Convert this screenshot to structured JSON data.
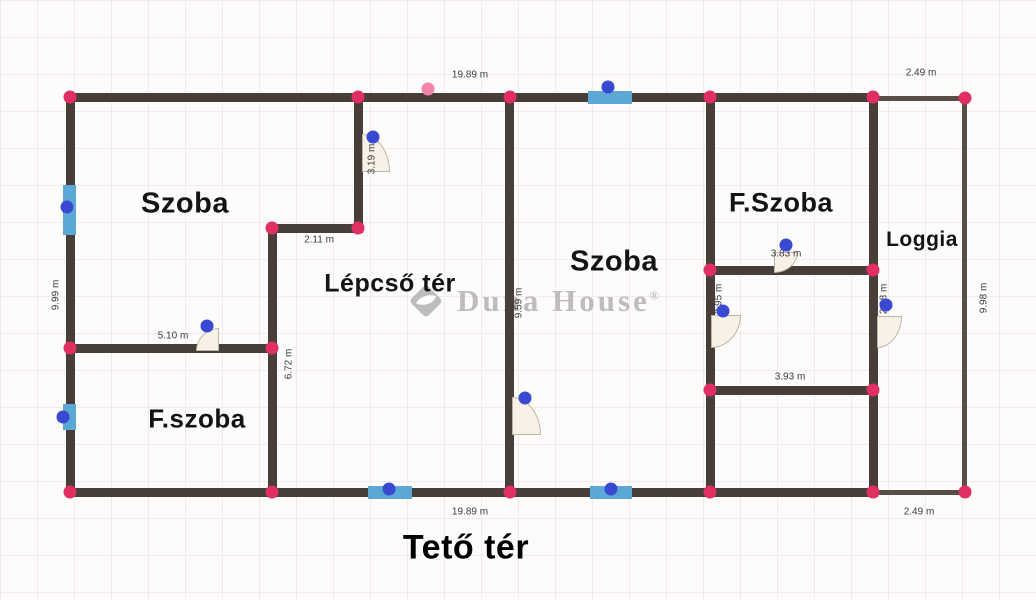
{
  "title": {
    "text": "Tető tér",
    "x": 466,
    "y": 548
  },
  "watermark": {
    "brand": "Duna House",
    "display": "Duna House",
    "registered": "®"
  },
  "colors": {
    "wall": "#473e39",
    "wall_thin": "#584e48",
    "corner_handle": "#e12e63",
    "corner_handle_light": "#f283ab",
    "opening_handle": "#3a49d2",
    "window": "#5ba7d6",
    "door_fill": "#f8f1e6",
    "door_border": "#bdb5a8",
    "label": "#141414",
    "dimension": "#3c3c3c",
    "watermark": "#b5b2b2",
    "title": "#000000"
  },
  "rooms": [
    {
      "label": "Szoba",
      "x": 185,
      "y": 204,
      "size": 29
    },
    {
      "label": "Lépcső tér",
      "x": 390,
      "y": 284,
      "size": 25
    },
    {
      "label": "F.szoba",
      "x": 197,
      "y": 419,
      "size": 26
    },
    {
      "label": "Szoba",
      "x": 614,
      "y": 262,
      "size": 29
    },
    {
      "label": "F.Szoba",
      "x": 781,
      "y": 203,
      "size": 27
    },
    {
      "label": "Loggia",
      "x": 922,
      "y": 240,
      "size": 21
    }
  ],
  "dimensions": [
    {
      "text": "19.89 m",
      "x": 470,
      "y": 75
    },
    {
      "text": "2.49 m",
      "x": 921,
      "y": 73
    },
    {
      "text": "9.99 m",
      "x": 56,
      "y": 295,
      "v": 1
    },
    {
      "text": "3.19 m",
      "x": 372,
      "y": 159,
      "v": 1
    },
    {
      "text": "2.11 m",
      "x": 319,
      "y": 240
    },
    {
      "text": "5.10 m",
      "x": 173,
      "y": 336
    },
    {
      "text": "6.72 m",
      "x": 289,
      "y": 364,
      "v": 1
    },
    {
      "text": "9.59 m",
      "x": 519,
      "y": 303,
      "v": 1
    },
    {
      "text": "3.83 m",
      "x": 786,
      "y": 254
    },
    {
      "text": "2.95 m",
      "x": 719,
      "y": 299,
      "v": 1
    },
    {
      "text": "2.98 m",
      "x": 884,
      "y": 299,
      "v": 1
    },
    {
      "text": "3.93 m",
      "x": 790,
      "y": 377
    },
    {
      "text": "19.89 m",
      "x": 470,
      "y": 512
    },
    {
      "text": "2.49 m",
      "x": 919,
      "y": 512
    },
    {
      "text": "9.98 m",
      "x": 984,
      "y": 298,
      "v": 1
    }
  ],
  "plan": {
    "walls": [
      {
        "x": 66,
        "y": 93,
        "w": 812,
        "h": 9
      },
      {
        "x": 66,
        "y": 93,
        "w": 9,
        "h": 404
      },
      {
        "x": 66,
        "y": 488,
        "w": 812,
        "h": 9
      },
      {
        "x": 505,
        "y": 93,
        "w": 9,
        "h": 404
      },
      {
        "x": 706,
        "y": 93,
        "w": 9,
        "h": 404
      },
      {
        "x": 869,
        "y": 93,
        "w": 9,
        "h": 404
      },
      {
        "x": 354,
        "y": 93,
        "w": 9,
        "h": 140
      },
      {
        "x": 268,
        "y": 224,
        "w": 95,
        "h": 9
      },
      {
        "x": 268,
        "y": 224,
        "w": 9,
        "h": 273
      },
      {
        "x": 66,
        "y": 344,
        "w": 211,
        "h": 9
      },
      {
        "x": 706,
        "y": 266,
        "w": 172,
        "h": 9
      },
      {
        "x": 706,
        "y": 386,
        "w": 172,
        "h": 9
      },
      {
        "x": 878,
        "y": 96,
        "w": 89,
        "h": 5,
        "thin": 1
      },
      {
        "x": 962,
        "y": 96,
        "w": 5,
        "h": 399,
        "thin": 1
      },
      {
        "x": 878,
        "y": 490,
        "w": 89,
        "h": 5,
        "thin": 1
      }
    ],
    "windows": [
      {
        "x": 63,
        "y": 185,
        "w": 13,
        "h": 50
      },
      {
        "x": 63,
        "y": 404,
        "w": 13,
        "h": 26
      },
      {
        "x": 588,
        "y": 91,
        "w": 44,
        "h": 13
      },
      {
        "x": 368,
        "y": 486,
        "w": 44,
        "h": 13
      },
      {
        "x": 590,
        "y": 486,
        "w": 42,
        "h": 13
      }
    ],
    "doors": [
      {
        "x": 362,
        "y": 134,
        "w": 28,
        "h": 38,
        "round": "tr"
      },
      {
        "x": 196,
        "y": 328,
        "w": 23,
        "h": 23,
        "round": "tl"
      },
      {
        "x": 512,
        "y": 397,
        "w": 29,
        "h": 38,
        "round": "tr"
      },
      {
        "x": 774,
        "y": 252,
        "w": 24,
        "h": 21,
        "round": "br"
      },
      {
        "x": 711,
        "y": 315,
        "w": 30,
        "h": 33,
        "round": "br"
      },
      {
        "x": 877,
        "y": 316,
        "w": 25,
        "h": 32,
        "round": "br"
      }
    ],
    "corner_handles": [
      {
        "x": 70,
        "y": 97
      },
      {
        "x": 358,
        "y": 97
      },
      {
        "x": 510,
        "y": 97
      },
      {
        "x": 710,
        "y": 97
      },
      {
        "x": 873,
        "y": 97
      },
      {
        "x": 965,
        "y": 98
      },
      {
        "x": 428,
        "y": 89,
        "light": 1
      },
      {
        "x": 70,
        "y": 348
      },
      {
        "x": 70,
        "y": 492
      },
      {
        "x": 272,
        "y": 228
      },
      {
        "x": 358,
        "y": 228
      },
      {
        "x": 272,
        "y": 348
      },
      {
        "x": 272,
        "y": 492
      },
      {
        "x": 510,
        "y": 492
      },
      {
        "x": 710,
        "y": 270
      },
      {
        "x": 873,
        "y": 270
      },
      {
        "x": 710,
        "y": 390
      },
      {
        "x": 873,
        "y": 390
      },
      {
        "x": 710,
        "y": 492
      },
      {
        "x": 873,
        "y": 492
      },
      {
        "x": 965,
        "y": 492
      }
    ],
    "opening_handles": [
      {
        "x": 67,
        "y": 207
      },
      {
        "x": 63,
        "y": 417
      },
      {
        "x": 608,
        "y": 87
      },
      {
        "x": 389,
        "y": 489
      },
      {
        "x": 611,
        "y": 489
      },
      {
        "x": 373,
        "y": 137
      },
      {
        "x": 525,
        "y": 398
      },
      {
        "x": 786,
        "y": 245
      },
      {
        "x": 723,
        "y": 311
      },
      {
        "x": 886,
        "y": 305
      },
      {
        "x": 207,
        "y": 326
      }
    ]
  }
}
